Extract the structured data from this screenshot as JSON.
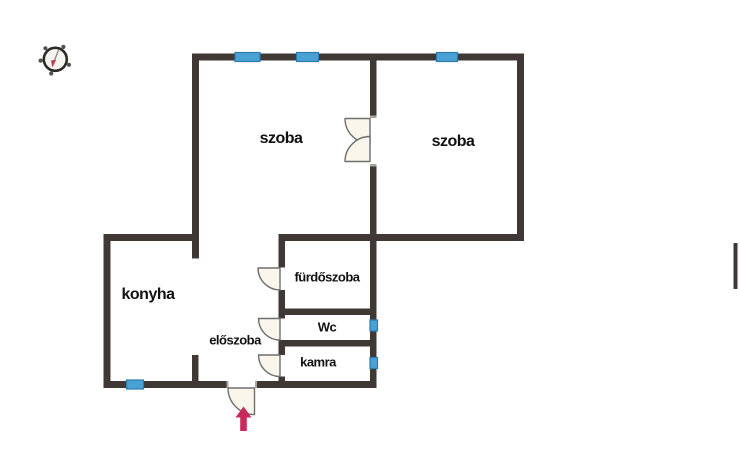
{
  "colors": {
    "bg": "#ffffff",
    "wall": "#3f3835",
    "jamb": "#aaa49d",
    "window-fill": "#4aa2d4",
    "window-border": "#2a7cb0",
    "door-fill": "#faf6ec",
    "door-stroke": "#6e6e6e",
    "arrow": "#c82a5c",
    "label": "#111111",
    "compass-face": "#f7f5f0",
    "compass-ring": "#2d2b29",
    "compass-knob": "#55504c",
    "compass-tail": "#8a8680",
    "compass-needle": "#c13a4a"
  },
  "icons": {
    "compass": "compass-north-icon",
    "entrance_arrow": "entrance-arrow-icon"
  },
  "rooms": {
    "szoba_left": {
      "label": "szoba"
    },
    "szoba_right": {
      "label": "szoba"
    },
    "konyha": {
      "label": "konyha"
    },
    "furdoszoba": {
      "label": "fürdőszoba"
    },
    "wc": {
      "label": "Wc"
    },
    "kamra": {
      "label": "kamra"
    },
    "eloszoba": {
      "label": "előszoba"
    }
  }
}
